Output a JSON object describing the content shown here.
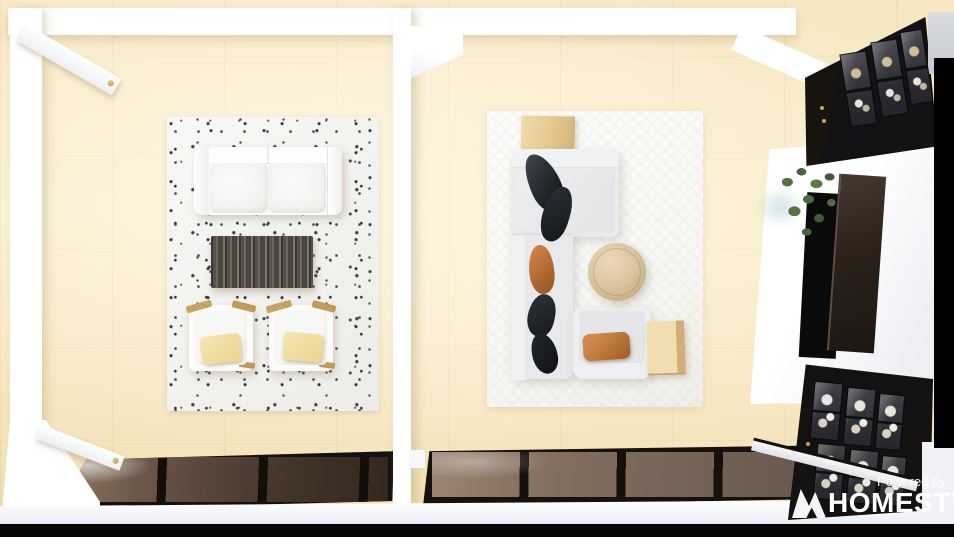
{
  "watermark": {
    "powered_by": "Powered by",
    "brand": "HOMESTYLER",
    "logo": "homestyler-logo-icon"
  },
  "scene": {
    "description": "Top-down 3D render of two adjoining living rooms with light wood flooring",
    "left_room": {
      "furniture": [
        "white loveseat sofa",
        "dark wood coffee table",
        "white armchair with yellow pillow (left)",
        "white armchair with yellow pillow (right)",
        "white speckled area rug"
      ],
      "fixtures": [
        "open door top-left with gold knob",
        "open door bottom-left with gold knob",
        "floor-to-ceiling window wall at bottom"
      ]
    },
    "right_room": {
      "furniture": [
        "light gray L-shaped sectional sofa",
        "black throw pillows",
        "rust orange throw pillows",
        "round light-wood coffee table",
        "square light-wood side table (top)",
        "light-wood end table (right)",
        "armchair with orange pillow",
        "white area rug"
      ],
      "fixtures": [
        "floor-to-ceiling window wall at bottom",
        "black glass-front display cabinet (upper right)",
        "black glass-front display cabinet (lower right)",
        "white media console",
        "wall-mounted TV",
        "potted green plant"
      ]
    }
  },
  "colors": {
    "floor": "#f9ecca",
    "wall": "#ffffff",
    "rug_left": "#f6f6f4",
    "rug_right": "#fbfbf8",
    "sofa_white": "#fafaf9",
    "sectional_gray": "#e7e9ea",
    "coffee_table_dark_wood": "#57514a",
    "pillow_yellow": "#f0dfa2",
    "pillow_black": "#1b1e22",
    "pillow_orange": "#b96a33",
    "wood_light": "#e8d3a2",
    "round_table_wood": "#d9c4a4",
    "window_glass_left": "#55443a",
    "window_glass_right": "#7b695c",
    "window_frame": "#15110d",
    "cabinet_black": "#131112",
    "cabinet_knob_gold": "#cfa63c",
    "tv_screen": "#2b2119",
    "plant_green": "#4e6a3f",
    "edge_black": "#060606"
  }
}
